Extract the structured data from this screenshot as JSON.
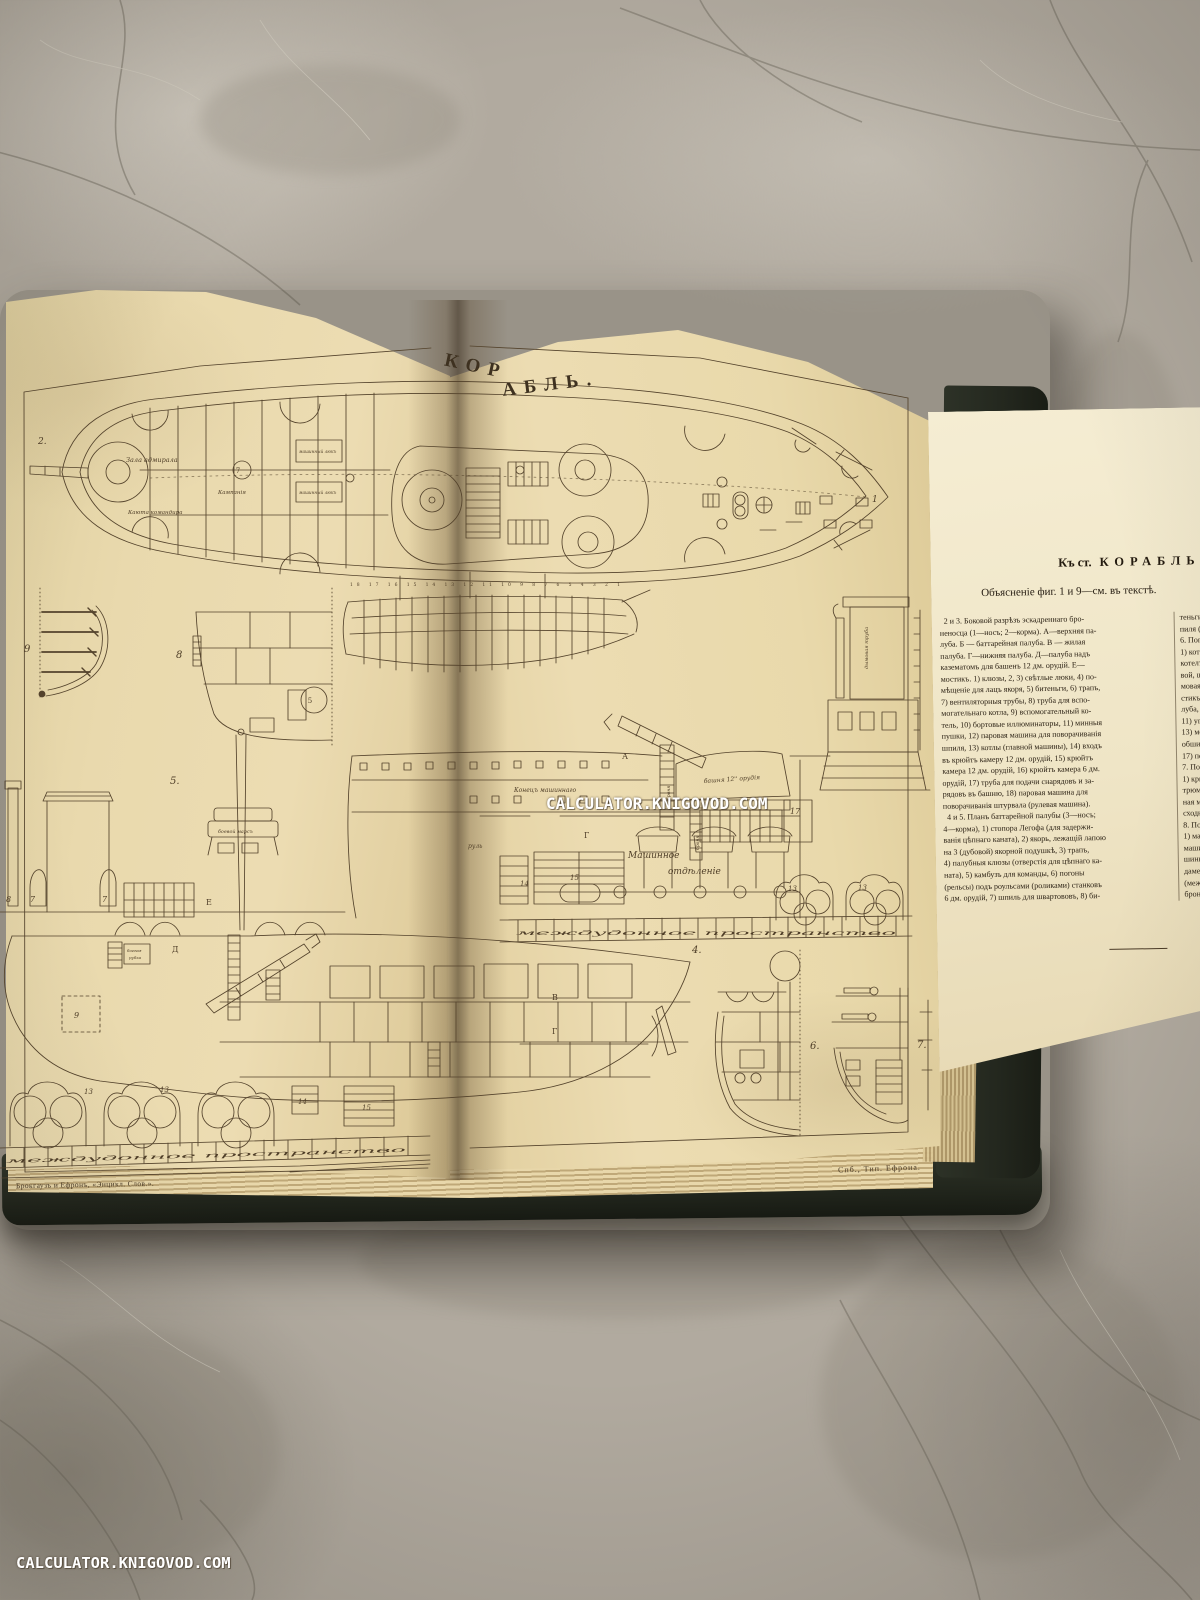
{
  "photo": {
    "watermark_center": "CALCULATOR.KNIGOVOD.COM",
    "watermark_bottom": "CALCULATOR.KNIGOVOD.COM"
  },
  "plate": {
    "title_left": "КОР",
    "title_right": "АБЛЬ.",
    "title_full": "КОРАБЛЬ.",
    "imprint_left": "Брокгаузъ и Ефронъ, «Энцикл. Слов.».",
    "imprint_right": "Спб., Тип. Ефрона.",
    "labels": {
      "zala_admirala": "Зала адмирала",
      "kayuta_komandira": "Каюта командира",
      "kampaniya": "Кампанія",
      "mashinny_lyuk": "машинный люкъ",
      "konets_mashinnago": "Конецъ машиннаго",
      "bashnya": "башня 12'' орудія",
      "boevaya_rubka_1": "боевая",
      "boevaya_rubka_2": "рубка",
      "boevoy_mars": "боевой марсъ",
      "dymovaya_truba": "дымовая труба",
      "rul": "руль",
      "bronya": "броня",
      "mashinnoe_1": "Машинное",
      "mashinnoe_2": "отдѣленіе",
      "mezhdudonnoe": "междудонное пространство",
      "fig1_scale": "18 17 16 15 14 13 12 11 10 9 8 7 6 5 4 3 2 1"
    },
    "marks": {
      "n1": "1",
      "n2": "2.",
      "n4": "4.",
      "n5": "5.",
      "n5p": "5",
      "n6": "6.",
      "n7": "7.",
      "n7p": "7",
      "n8": "8",
      "n9": "9",
      "n13": "13",
      "n14": "14",
      "n15": "15",
      "n17": "17",
      "dA": "А",
      "dB": "В",
      "dG": "Г",
      "dD": "Д",
      "dE": "Е"
    }
  },
  "leaf": {
    "heading_prefix": "Къ ст.",
    "heading_title": "КОРАБЛЬ",
    "subheading": "Объясненіе фиг. 1 и 9—см. въ текстѣ.",
    "col1": "  2 и 3. Боковой разрѣзъ эскадреннаго бро-\nненосца (1—носъ; 2—корма). А—верхняя па-\nлуба. Б — баттарейная палуба. В — жилая\nпалуба. Г—нижняя палуба. Д—палуба надъ\nказематомъ для башенъ 12 дм. орудій. Е—\nмостикъ. 1) клюзы, 2, 3) свѣтлые люки, 4) по-\nмѣщеніе для лацъ якоря, 5) битеньги, 6) трапъ,\n7) вентиляторныя трубы, 8) труба для вспо-\nмогательнаго котла, 9) вспомогательный ко-\nтель, 10) бортовые иллюминаторы, 11) минныя\nпушки, 12) паровая машина для поворачиванія\nшпиля, 13) котлы (главной машины), 14) входъ\nвъ крюйтъ камеру 12 дм. орудій, 15) крюйтъ\nкамера 12 дм. орудій, 16) крюйтъ камера 6 дм.\nорудій, 17) труба для подачи снарядовъ и за-\nрядовъ въ башню, 18) паровая машина для\nповорачиванія штурвала (рулевая машина).\n  4 и 5. Планъ баттарейной палубы (3—носъ;\n4—корма), 1) стопора Легофа (для задержи-\nванія цѣпнаго каната), 2) якорь, лежащій лапою\nна 3 (дубовой) якорной подушкѣ, 3) трапъ,\n4) палубныя клюзы (отверстія для цѣпнаго ка-\nната), 5) камбузъ для команды, 6) погоны\n(рельсы) подъ роульсами (роликами) станковъ\n6 дм. орудій, 7) шпиль для швартововъ, 8) би-",
    "col2": "теньги, 9)\nпиля (низ\n6. Попе\n1) котелъ (\nкотелъ (дл\nвой, шпил\nмовая тру\nстикъ, 7)\nлуба, 9)\n11) уголь\n13) межд\nобшивка,\n17) переб\n7. Поп\n1) крюйт\nтрюмъ (\nная му\nсходные\n8. Поп\n1) маши\nмашинна\nшины, 5\nдаменть,\n(между\nброня."
  }
}
